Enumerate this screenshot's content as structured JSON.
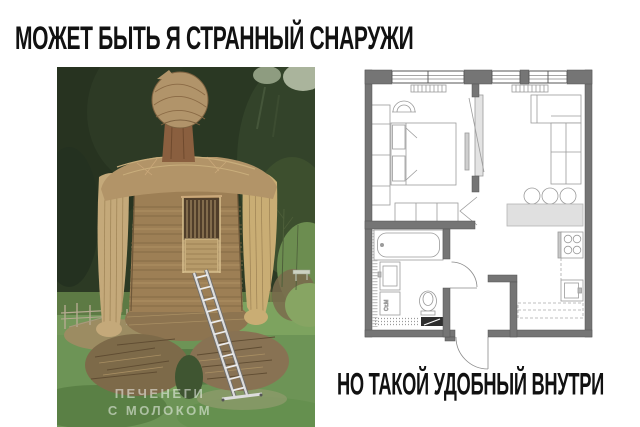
{
  "meme": {
    "top_text": "МОЖЕТ БЫТЬ Я СТРАННЫЙ СНАРУЖИ",
    "bottom_text": "НО ТАКОЙ УДОБНЫЙ ВНУТРИ"
  },
  "photo": {
    "watermark_line1": "ПЕЧЕНЕГИ",
    "watermark_line2": "С МОЛОКОМ"
  },
  "floorplan": {
    "washing_machine_label": "Ст.М"
  },
  "colors": {
    "text": "#111111",
    "wall_gray": "#757575",
    "plan_line": "#9b9b9b",
    "grass_green": "#6d9456",
    "forest_green": "#2c3a24",
    "straw_tan": "#c4a97a",
    "wicker_brown": "#9d7f55",
    "ladder_silver": "#dcdcdc"
  }
}
